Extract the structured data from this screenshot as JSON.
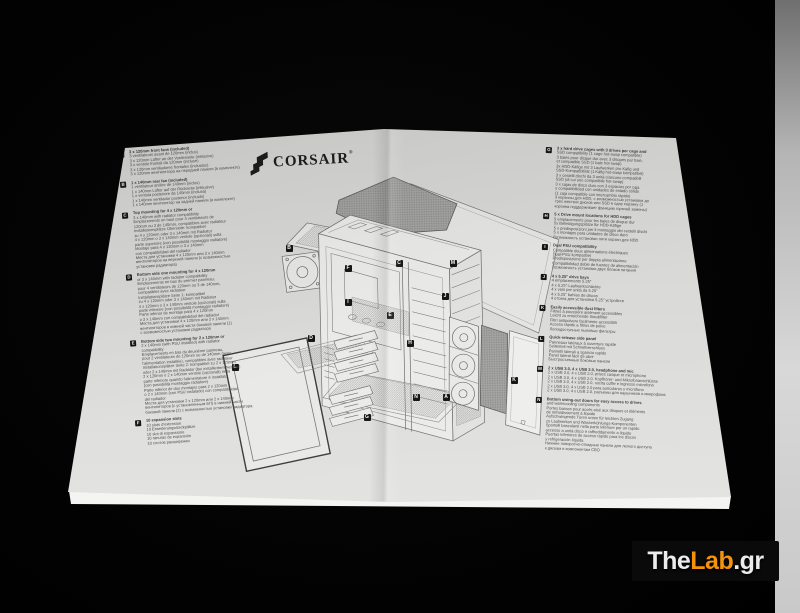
{
  "brand": {
    "name": "CORSAIR",
    "registered": "®"
  },
  "sections_left": [
    {
      "letter": "A",
      "lines": [
        "3 x 120mm front fans (included)",
        "3 ventilateurs avant de 120mm (inclus)",
        "3 x 120mm Lüfter an der Vorderseite (inklusive)",
        "3 x ventole frontali da 120mm (incluse)",
        "3 x 120mm ventiladores frontales (incluidos)",
        "3 x 120mm вентилятора на передней панели (в комплекте)"
      ]
    },
    {
      "letter": "B",
      "lines": [
        "1 x 140mm rear fan (included)",
        "1 ventilateur arrière de 140mm (inclus)",
        "1 x 140mm Lüfter auf der Rückseite (inklusive)",
        "1 x ventola posteriore da 140mm (inclusa)",
        "1 x 140mm ventilador posterior (incluido)",
        "1 x 140mm вентилятор на задней панели (в комплекте)"
      ]
    },
    {
      "letter": "C",
      "lines": [
        "Top mounting for 4 x 120mm or",
        "3 x 140mm with radiator compatibility",
        "Emplacements en haut pour 4 ventilateurs de",
        "120mm ou 3 de 140mm, compatibles avec radiateur",
        "Installationsplätze Oberseite: kompatibel",
        "zu 4 x 120mm oder 3 x 140mm mit Radiator",
        "4 x 120mm o 3 x 140mm ventole (opzionali) sulla",
        "parte superiore (con possibilità montaggio radiatore)",
        "Montaje para 4 x 120mm o 3 x 140mm",
        "con compatibilidad del radiador",
        "Места для установки 4 x 120mm или 3 x 140mm",
        "вентиляторов на верхней панели (с возможностью",
        "установки радиатора)"
      ]
    },
    {
      "letter": "D",
      "lines": [
        "Bottom side one mounting for 4 x 120mm",
        "or 3 x 140mm with radiator compatibility",
        "Emplacements en bas du premier panneau,",
        "pour 4 ventilateurs de 120mm ou 3 de 140mm,",
        "compatibles avec radiateur",
        "Installationsplätze Seite 1: kompatibel",
        "zu 4 x 120mm oder 3 x 140mm mit Radiator",
        "4 x 120mm o 3 x 140mm ventole (opzionali) sulla",
        "parte inferiore (con possibilità montaggio radiatore)",
        "Parte inferior de montaje para 4 x 120mm",
        "o 3 x 140mm con compatibilidad del radiador",
        "Места для установки 4 x 120mm или 3 x 140mm",
        "вентиляторов в нижней части боковой панели (1)",
        "с возможностью установки радиатора"
      ]
    },
    {
      "letter": "E",
      "lines": [
        "Bottom side two mounting for 2 x 120mm or",
        "2 x 140mm (with PSU installed) with radiator",
        "compatibility",
        "Emplacements en bas du deuxième panneau,",
        "pour 2 ventilateurs de 120mm ou de 140mm (avec",
        "l'alimentation installée), compatibles avec radiateur",
        "Installationsplätze Seite 2: kompatibel zu 2 x 120mm",
        "oder 2 x 140mm mit Radiator (bei installiertem Netzteil)",
        "2 x 120mm o 2 x 140mm ventole (opzionali) nella",
        "parte inferiore quando l'alimentatore è installato",
        "(con possibilità montaggio radiatore)",
        "Parte inferior de dos montajes para 2 x 120mm",
        "o 2 x 140mm (con PSU instalado) con compatibilidad",
        "del radiador",
        "Места для установки 2 x 120mm или 2 x 140mm",
        "вентиляторов (с установленным БП) в нижней части",
        "боковой панели (2) с возможностью установки радиатора"
      ]
    },
    {
      "letter": "F",
      "lines": [
        "10 expansion slots",
        "10 slots d'extension",
        "10 Erweiterungssteckplätze",
        "10 slot di espansione",
        "10 ranuras de expansión",
        "10 слотов расширения"
      ]
    }
  ],
  "sections_right": [
    {
      "letter": "G",
      "lines": [
        "3 x hard drive cages with 3 drives per cage and",
        "SSD compatibility (1 cage hot-swap compatible)",
        "3 baies pour disque dur avec 3 disques par baie,",
        "et compatible SSD (1 baie hot-swap)",
        "3x HDD-Käfige mit 3 Laufwerken pro Käfig und",
        "SSD-Kompatibilität (1 Käfig hot-swap kompatibel)",
        "3 x cestelli dischi da 3 unità ciascuno compatibili",
        "SSD (di cui uno compatibile hot-swap)",
        "3 x cajas de disco duro con 3 espacios por caja",
        "y compatibilidad con unidades de estado sólido",
        "(1 caja compatible con intercambio rápido)",
        "3 корзины для HDD, с возможностью установки до",
        "трех жестких дисков или SSD в одну корзину (1",
        "корзина поддерживает функцию горячей замены)"
      ]
    },
    {
      "letter": "H",
      "lines": [
        "5 x Drive mount locations for HDD cages",
        "5 emplacements pour les baies de disque dur",
        "5x Befestigungsplätze für HDD-Käfige",
        "5 x predisposizioni per il montaggio dei cestelli dischi",
        "5 x montajes para unidades de disco duro",
        "Возможность установки пяти корзин для HDD"
      ]
    },
    {
      "letter": "I",
      "lines": [
        "Dual PSU compatibility",
        "Compatible deux alimentations électriques",
        "Dual-PSU kompatibel",
        "Predisposizione per doppia alimentazione",
        "Compatibilidad doble de fuentes de alimentación",
        "Возможность установки двух блоков питания"
      ]
    },
    {
      "letter": "J",
      "lines": [
        "4 x 5.25\" drive bays",
        "4 emplacements 5.25\"",
        "4 x 5.25\"-Laufwerkschächte",
        "4 x vani per unità da 5.25\"",
        "4 x 5.25\" bahías de discos",
        "4 отсека для установки 5.25\" устройств"
      ]
    },
    {
      "letter": "K",
      "lines": [
        "Easily accessible dust filters",
        "Filtres à poussière aisément accessibles",
        "Leicht zu erreichende Staubfilter",
        "Filtri antipolvere facilmente accessibili",
        "Acceso rápido a filtros de polvo",
        "Легкодоступные пылевые фильтры"
      ]
    },
    {
      "letter": "L",
      "lines": [
        "Quick-release side panel",
        "Panneaux latéraux à ouverture rapide",
        "Seitenteil mit Schnellverschluss",
        "Pannelli laterali a sgancio rapido",
        "Panel lateral fácil de abrir",
        "Быстросъемные боковые панели"
      ]
    },
    {
      "letter": "M",
      "lines": [
        "2 x USB 3.0, 4 x USB 2.0, headphone and mic",
        "2 x USB 3.0, 4 x USB 2.0, prises casque et microphone",
        "2 x USB 3.0, 4 x USB 2.0, Kopfhörer- und Mikrofonanschlüsse",
        "2 x USB 3.0, 4 x USB 2.0, uscita cuffie e ingresso microfono",
        "2 x USB 3.0, 4 x USB 2.0 para auriculares y micrófono",
        "2 x USB 3.0, 4 x USB 2.0, разъемы для наушников и микрофона"
      ]
    },
    {
      "letter": "N",
      "lines": [
        "Bottom swing-out doors for easy access to drives",
        "and watercooling components",
        "Portes basses pour accès aisé aux disques et éléments",
        "de refroidissement à liquide",
        "Aufschwingende Türen unten für leichten Zugang",
        "zu Laufwerken und Wasserkühlungs-Komponenten",
        "Sportelli basculanti nella parte inferiore per un rapido",
        "accesso a unità disco e raffreddamento a liquido",
        "Puertas inferiores de acceso rápido para los discos",
        "y refrigeración líquida",
        "Нижние поворотно-откидные панели для легкого доступа",
        "к дискам и компонентам СВО"
      ]
    }
  ],
  "diagram": {
    "callouts": [
      {
        "letter": "A",
        "x": 446,
        "y": 397
      },
      {
        "letter": "B",
        "x": 289,
        "y": 248
      },
      {
        "letter": "C",
        "x": 399,
        "y": 263
      },
      {
        "letter": "D",
        "x": 311,
        "y": 338
      },
      {
        "letter": "E",
        "x": 390,
        "y": 315
      },
      {
        "letter": "F",
        "x": 348,
        "y": 268
      },
      {
        "letter": "G",
        "x": 367,
        "y": 417
      },
      {
        "letter": "H",
        "x": 410,
        "y": 343
      },
      {
        "letter": "I",
        "x": 348,
        "y": 302
      },
      {
        "letter": "J",
        "x": 445,
        "y": 296
      },
      {
        "letter": "K",
        "x": 514,
        "y": 380
      },
      {
        "letter": "L",
        "x": 235,
        "y": 367
      },
      {
        "letter": "M",
        "x": 453,
        "y": 263
      },
      {
        "letter": "N",
        "x": 416,
        "y": 397
      }
    ]
  },
  "watermark": {
    "part1": "The",
    "part2": "Lab",
    "part3": ".gr",
    "silver": "#ececec",
    "orange": "#f5930c",
    "background": "#0a0a0a"
  },
  "colors": {
    "paper": "#d9d9d7",
    "background": "#000000",
    "ink": "#4c4c4c"
  }
}
